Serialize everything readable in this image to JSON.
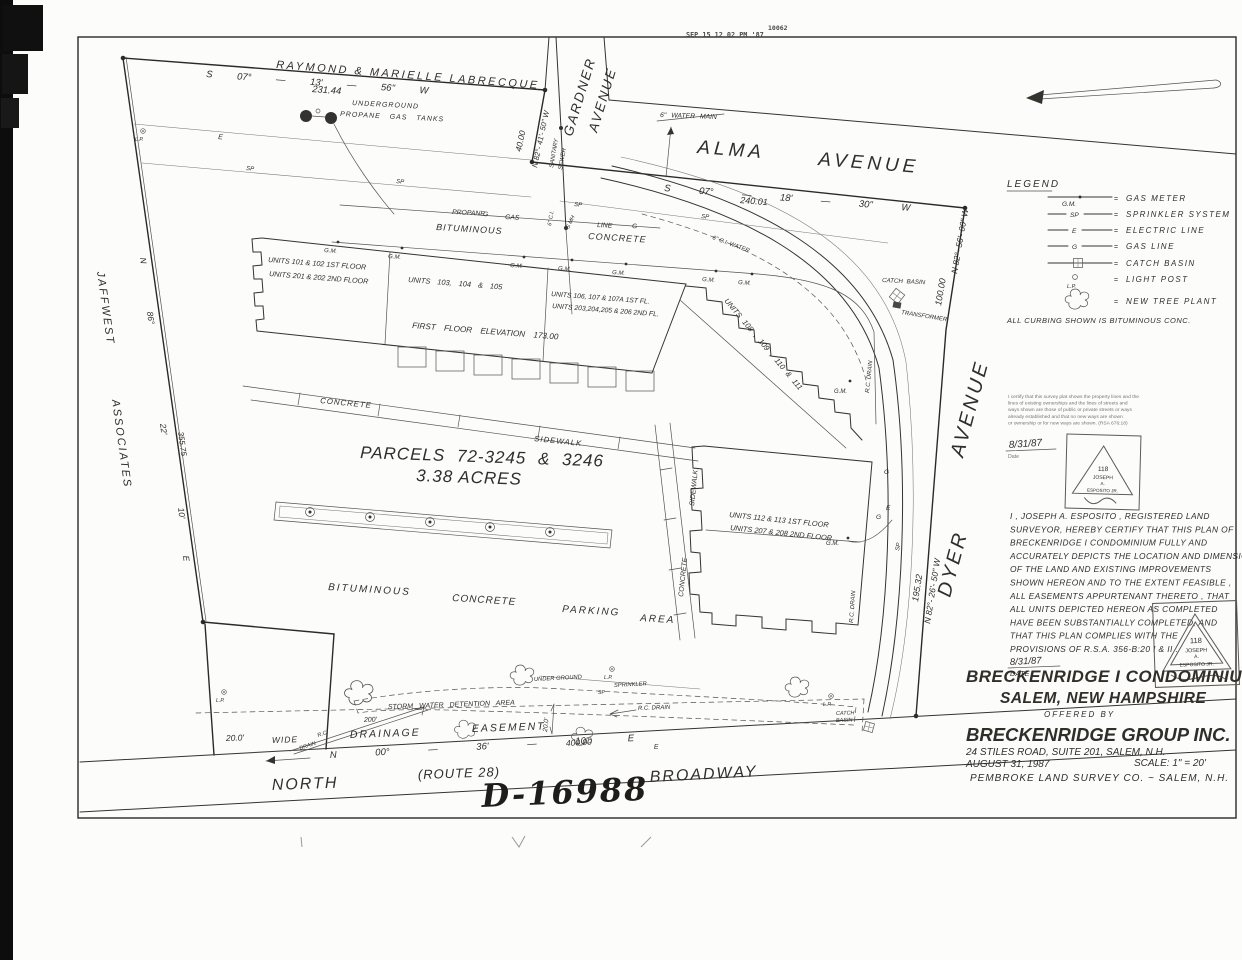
{
  "scan": {
    "received_stamp": "SEP 15 12 02 PM '87",
    "stamp_number": "10062"
  },
  "plan_number": "D-16988",
  "abutters": {
    "north_owner": "RAYMOND & MARIELLE LABRECQUE",
    "west_owner_1": "JAFFWEST",
    "west_owner_2": "ASSOCIATES"
  },
  "streets": {
    "gardner_1": "GARDNER",
    "gardner_2": "AVENUE",
    "alma_1": "ALMA",
    "alma_2": "AVENUE",
    "dyer_1": "DYER",
    "dyer_2": "AVENUE",
    "north_label": "NORTH",
    "route_label": "(ROUTE 28)",
    "broadway_label": "BROADWAY"
  },
  "bearings": {
    "north_bearing": "S 07° — 13' — 56\" W",
    "north_distance": "231.44",
    "gardner_width": "40.00",
    "gardner_bearing": "N 82°- 41'- 50\" W",
    "alma_bearing": "S 07° — 18' — 30\" W",
    "alma_distance": "240.01",
    "dyer_upper_distance": "100.00",
    "dyer_upper_bearing": "N 82°- 56'- 00\" W",
    "dyer_lower_distance": "195.32",
    "dyer_lower_bearing": "N 82°- 26'- 50\" W",
    "west_n": "N",
    "west_deg": "86°",
    "west_min": "22'",
    "west_sec": "10'",
    "west_e": "E",
    "west_distance": "355.75",
    "broadway_bearing": "N 00° — 36' — 10\" E",
    "broadway_distance": "400.00"
  },
  "site": {
    "underground": "UNDERGROUND",
    "propane_tanks": "PROPANE GAS TANKS",
    "sanitary": "SANITARY",
    "sewer": "SEWER",
    "smh": "S MH",
    "ci": "6\" C.I.",
    "water_main": "6\" WATER MAIN",
    "ci_water": "6\" C.I. WATER",
    "propane": "PROPANE",
    "gas": "GAS",
    "line": "LINE",
    "bituminous": "BITUMINOUS",
    "concrete": "CONCRETE",
    "sidewalk": "SIDEWALK",
    "parking": "PARKING",
    "area": "AREA",
    "parcels": "PARCELS 72-3245 & 3246",
    "acres": "3.38 ACRES",
    "gm": "G.M.",
    "sp": "SP",
    "e": "E",
    "g": "G",
    "lp": "L.P.",
    "catch_basin": "CATCH BASIN",
    "catch": "CATCH",
    "basin": "BASIN",
    "transformer": "TRANSFORMER",
    "rc_drain": "R.C. DRAIN",
    "rc": "R.C.",
    "drain": "DRAIN",
    "storm_water": "STORM WATER DETENTION AREA",
    "dim_200": "200'",
    "dim_20": "20.0'",
    "wide": "WIDE",
    "drainage": "DRAINAGE",
    "easement": "EASEMENT",
    "under_ground": "UNDER GROUND",
    "sprinkler": "SPRINKLER",
    "first_floor_elevation": "FIRST FLOOR ELEVATION 173.00"
  },
  "units": {
    "u101": "UNITS 101 & 102 1ST FLOOR",
    "u201": "UNITS 201 & 202 2ND FLOOR",
    "u103": "UNITS 103, 104 & 105",
    "u106": "UNITS 106, 107 & 107A 1ST FL.",
    "u203": "UNITS 203,204,205 & 206 2ND FL.",
    "u108": "UNITS 108 , 109 , 110 & 111",
    "u112": "UNITS 112 & 113 1ST FLOOR",
    "u207": "UNITS 207 & 208 2ND FLOOR"
  },
  "legend": {
    "title": "LEGEND",
    "eq": "=",
    "items": [
      {
        "symbol": "G.M.",
        "label": "GAS METER"
      },
      {
        "symbol": "SP",
        "label": "SPRINKLER SYSTEM"
      },
      {
        "symbol": "E",
        "label": "ELECTRIC LINE"
      },
      {
        "symbol": "G",
        "label": "GAS LINE"
      },
      {
        "symbol": "",
        "label": "CATCH BASIN"
      },
      {
        "symbol": "L.P.",
        "label": "LIGHT POST"
      },
      {
        "symbol": "",
        "label": "NEW TREE PLANT"
      }
    ],
    "note": "ALL CURBING SHOWN IS BITUMINOUS CONC."
  },
  "certification_stamp": {
    "lines": [
      "I certify that this survey plat shows the property lines and the",
      "lines of existing ownerships and the lines of streets and",
      "ways shown are those of public or private streets or ways",
      "already established and that no new ways are shown",
      "or ownership or for new ways are shown.      (RSA 676:18)"
    ],
    "date": "8/31/87",
    "date_label": "Date"
  },
  "surveyor_certificate": {
    "lines": [
      "I , JOSEPH A. ESPOSITO , REGISTERED LAND",
      "SURVEYOR, HEREBY CERTIFY THAT THIS PLAN OF",
      "BRECKENRIDGE I CONDOMINIUM FULLY AND",
      "ACCURATELY DEPICTS THE LOCATION AND DIMENSIONS",
      "OF THE LAND AND EXISTING IMPROVEMENTS",
      "SHOWN HEREON AND TO THE EXTENT FEASIBLE ,",
      "ALL EASEMENTS APPURTENANT THERETO , THAT",
      "ALL UNITS DEPICTED HEREON AS COMPLETED",
      "HAVE BEEN SUBSTANTIALLY COMPLETED, AND",
      "THAT THIS PLAN COMPLIES WITH THE",
      "PROVISIONS OF R.S.A. 356-B:20 I & II ."
    ],
    "date": "8/31/87",
    "date_label": "DATE"
  },
  "seal": {
    "number": "118",
    "name_1": "JOSEPH",
    "name_2": "A.",
    "name_3": "ESPOSITO JR."
  },
  "title_block": {
    "title_1": "BRECKENRIDGE I CONDOMINIUM",
    "title_2": "SALEM, NEW HAMPSHIRE",
    "offered_by": "OFFERED BY",
    "company": "BRECKENRIDGE GROUP INC.",
    "address": "24 STILES ROAD, SUITE 201, SALEM, N.H.",
    "date": "AUGUST 31, 1987",
    "scale": "SCALE: 1\" = 20'",
    "surveyor": "PEMBROKE LAND SURVEY CO. ~ SALEM, N.H."
  }
}
